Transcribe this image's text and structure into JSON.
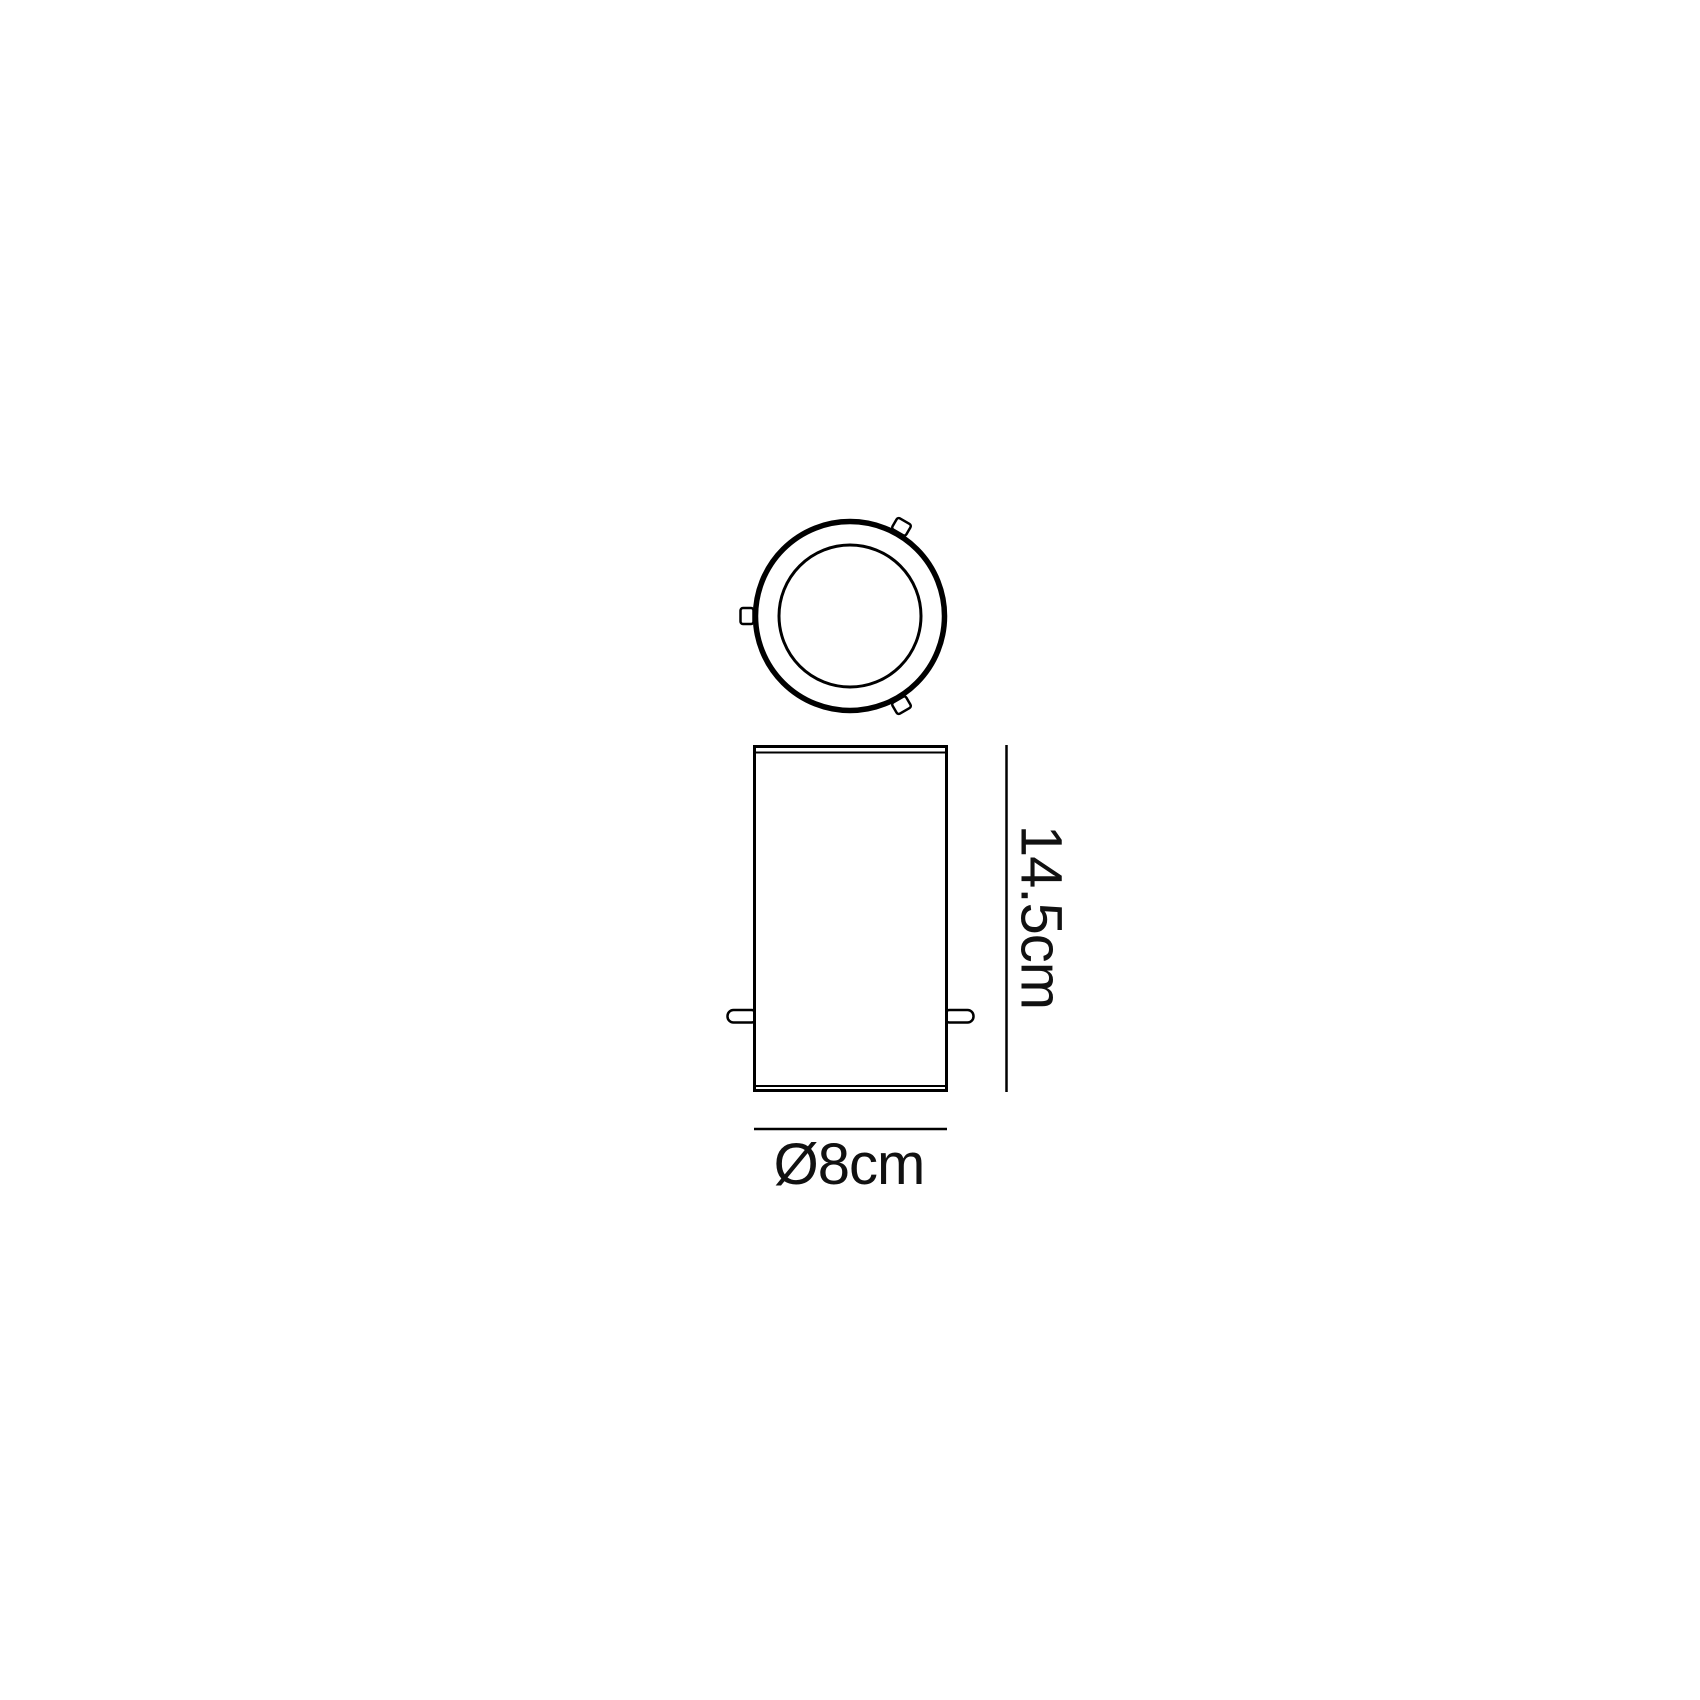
{
  "page": {
    "background": "#ffffff"
  },
  "diagram": {
    "labels": {
      "height": "14.5cm",
      "diameter": "Ø8cm"
    },
    "colors": {
      "line": "#000000",
      "text": "#111111",
      "fill": "#ffffff"
    }
  }
}
